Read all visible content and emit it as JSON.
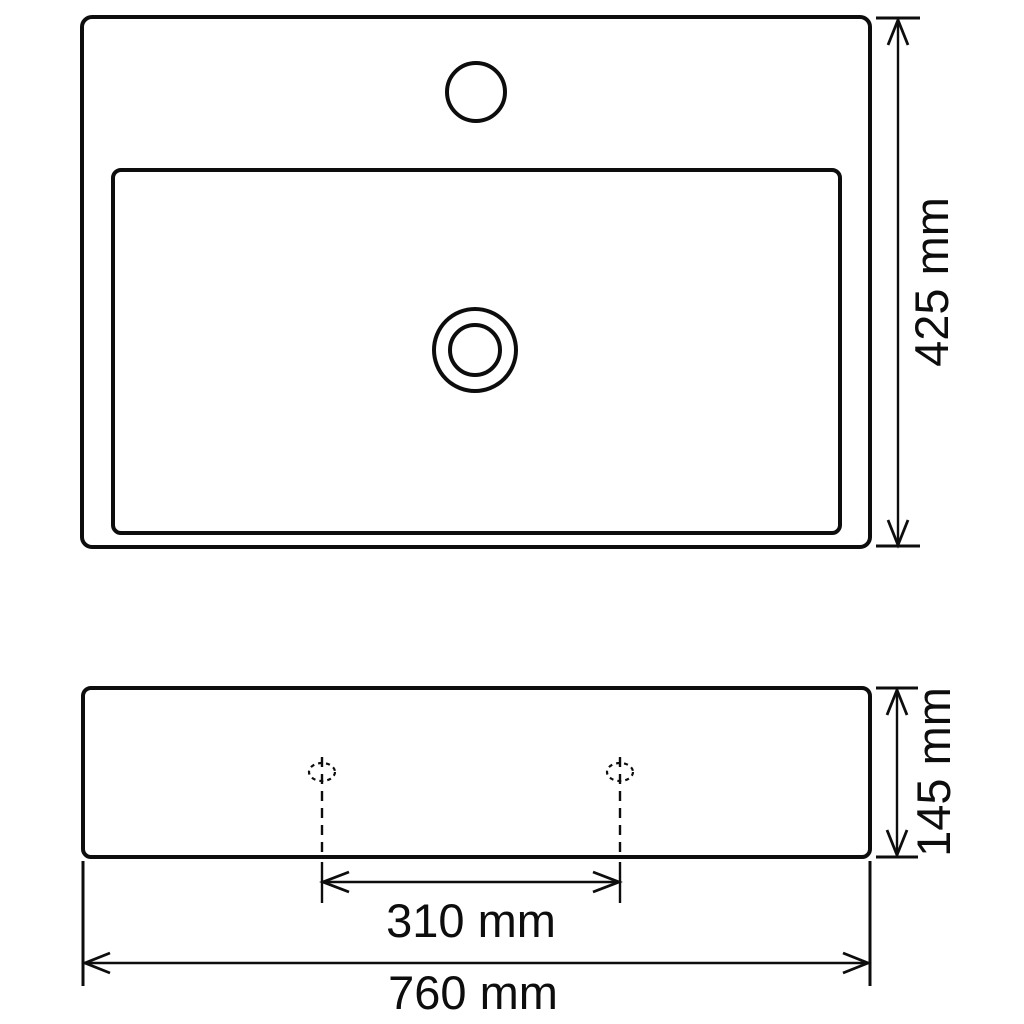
{
  "document": {
    "type": "technical-dimension-drawing",
    "subject": "rectangular basin / sink with faucet hole, top view and front view",
    "background_color": "#ffffff",
    "line_color": "#0d0d0d"
  },
  "views": {
    "top_view": {
      "name": "top view",
      "features": {
        "outer_outline": "sink outer edge, rounded-corner rectangle",
        "basin_rim": "inner basin opening rectangle",
        "faucet_hole": "single round tap hole at top centre",
        "drain": "concentric double circle waste outlet at basin centre"
      }
    },
    "front_view": {
      "name": "front view",
      "features": {
        "outline": "sink body, rounded-corner rectangle",
        "mounting_holes": "two hidden holes shown as dashed ellipses with dashed centre lines"
      }
    }
  },
  "dimensions": {
    "depth_label": "425 mm",
    "height_label": "145 mm",
    "hole_spacing_label": "310 mm",
    "width_label": "760 mm",
    "values_mm": {
      "depth": 425,
      "height": 145,
      "hole_spacing": 310,
      "width": 760
    }
  }
}
